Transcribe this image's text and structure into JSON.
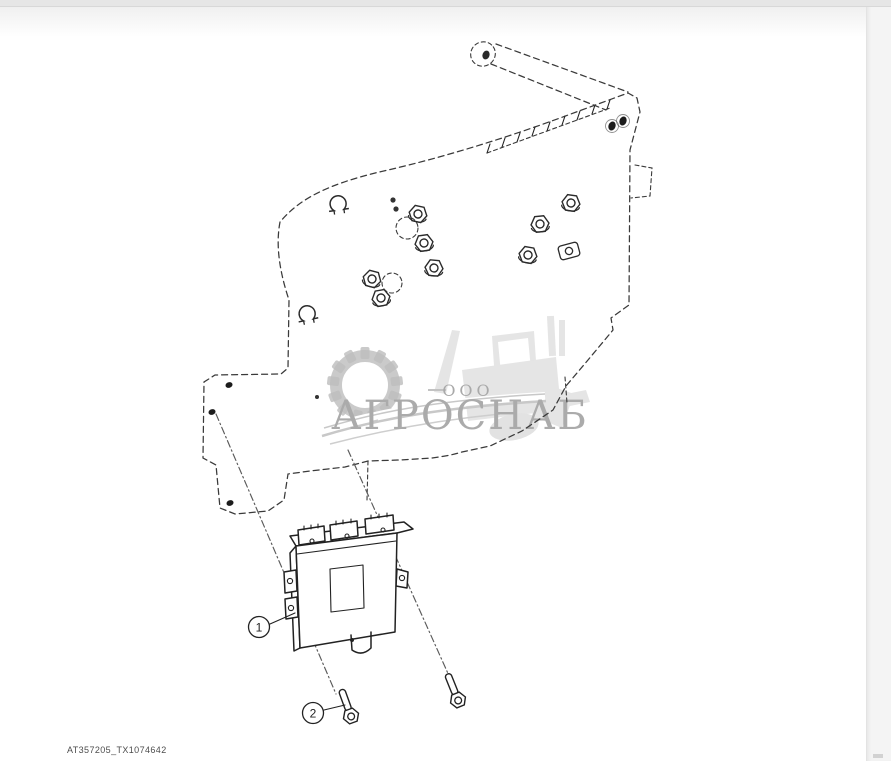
{
  "page": {
    "background": "#ffffff",
    "chrome": {
      "top_bar_color": "#e6e6e6",
      "side_strip_color": "#f4f4f4"
    }
  },
  "diagram": {
    "type": "exploded-parts-drawing",
    "line_color": "#3a3a3a",
    "callouts": [
      {
        "label": "1"
      },
      {
        "label": "2"
      }
    ]
  },
  "watermark": {
    "prefix": "ООО",
    "name": "АГРОСНАБ",
    "text_color": "#ababab",
    "art_color": "#c4c4c4",
    "machine_color": "#e3e3e3",
    "icons": [
      "gear-icon",
      "tractor-icon"
    ]
  },
  "footer": {
    "figure_id": "AT357205_TX1074642"
  }
}
